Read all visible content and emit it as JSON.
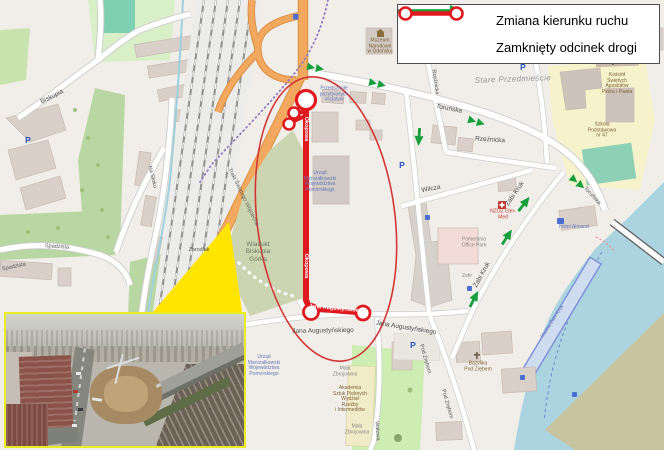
{
  "legend": {
    "items": [
      {
        "icon": "green-direction-arrow",
        "label": "Zmiana kierunku ruchu"
      },
      {
        "icon": "closed-road-segment",
        "label": "Zamknięty odcinek drogi"
      }
    ]
  },
  "colors": {
    "accent_red": "#e0191f",
    "arrow_green": "#179e3d",
    "highlight_yellow": "#ffe500",
    "water": "#abd4e0",
    "building": "#d9d0c9",
    "road_orange": "#f2a95f",
    "park": "#c9e3ae",
    "hill": "#cbd5b1",
    "khaki": "#c9c4a0",
    "bg": "#f1eee9"
  },
  "map": {
    "closed_section_streets": [
      "Okopowa",
      "Jana Augustyńskiego"
    ],
    "labels": [
      {
        "name": "street-torunska",
        "cls": "street",
        "text": "Toruńska",
        "x": 449,
        "y": 109,
        "rot": 11
      },
      {
        "name": "street-torunska-2",
        "cls": "street-sm",
        "text": "Toruńska",
        "x": 592,
        "y": 196,
        "rot": 48
      },
      {
        "name": "street-rzeznicka-v",
        "cls": "street-sm",
        "text": "Rzeźnicka",
        "x": 435,
        "y": 82,
        "rot": 82
      },
      {
        "name": "street-rzeznicka-h",
        "cls": "street",
        "text": "Rzeźnicka",
        "x": 490,
        "y": 140,
        "rot": 4
      },
      {
        "name": "area-stare-przedmiescie",
        "cls": "area",
        "text": "Stare Przedmieście",
        "x": 513,
        "y": 80,
        "rot": -2
      },
      {
        "name": "street-wilcza",
        "cls": "street",
        "text": "Wilcza",
        "x": 431,
        "y": 189,
        "rot": -11
      },
      {
        "name": "street-zabi-kruk-1",
        "cls": "street",
        "text": "Żabi Kruk",
        "x": 515,
        "y": 194,
        "rot": -55
      },
      {
        "name": "street-zabi-kruk-2",
        "cls": "street",
        "text": "Żabi Kruk",
        "x": 482,
        "y": 275,
        "rot": -62
      },
      {
        "name": "street-jana-aug-1",
        "cls": "street",
        "text": "Jana Augustyńskiego",
        "x": 323,
        "y": 331,
        "rot": -1
      },
      {
        "name": "street-jana-aug-2",
        "cls": "street",
        "text": "Jana Augustyńskiego",
        "x": 406,
        "y": 328,
        "rot": 9
      },
      {
        "name": "street-jana-aug-red",
        "cls": "onred",
        "text": "Jana Augustyńskiego",
        "x": 337,
        "y": 309,
        "rot": 5
      },
      {
        "name": "street-pod-zrebem-1",
        "cls": "street-sm",
        "text": "Pod Zrębem",
        "x": 425,
        "y": 359,
        "rot": 74
      },
      {
        "name": "street-pod-zrebem-2",
        "cls": "street-sm",
        "text": "Pod Zrębem",
        "x": 447,
        "y": 404,
        "rot": 74
      },
      {
        "name": "street-walowa",
        "cls": "street-sm",
        "text": "Wałowa",
        "x": 377,
        "y": 431,
        "rot": 86
      },
      {
        "name": "street-okopowa-red-1",
        "cls": "onred",
        "text": "Okopowa",
        "x": 306,
        "y": 129,
        "rot": 90
      },
      {
        "name": "street-okopowa-red-2",
        "cls": "onred",
        "text": "Okopowa",
        "x": 306,
        "y": 266,
        "rot": 90
      },
      {
        "name": "street-trakt",
        "cls": "street-sm",
        "text": "Trakt Świętego Wojciecha",
        "x": 243,
        "y": 197,
        "rot": 64
      },
      {
        "name": "street-biskupia",
        "cls": "street",
        "text": "Biskupia",
        "x": 52,
        "y": 97,
        "rot": -27
      },
      {
        "name": "street-na-stoku",
        "cls": "street-sm",
        "text": "Na Stoku",
        "x": 152,
        "y": 177,
        "rot": 76
      },
      {
        "name": "street-spadzista-1",
        "cls": "street-sm",
        "text": "Spadzista",
        "x": 57,
        "y": 247,
        "rot": 4
      },
      {
        "name": "street-spadzista-2",
        "cls": "street-sm",
        "text": "Spadzista",
        "x": 14,
        "y": 267,
        "rot": -12
      },
      {
        "name": "street-zaroslak",
        "cls": "street-sm",
        "text": "Zaroślak",
        "x": 199,
        "y": 250,
        "rot": 0
      },
      {
        "name": "area-wiadukt-biskupia-gorka",
        "cls": "hill-label",
        "text": "Wiadukt\nBiskupia\nGórka",
        "x": 258,
        "y": 252,
        "rot": 0
      },
      {
        "name": "poi-przedszkole",
        "cls": "poi-blue",
        "text": "Przedszkole\npozytywnych\ninicjatyw",
        "x": 334,
        "y": 95,
        "rot": 0
      },
      {
        "name": "poi-urzad-marszalkowski-1",
        "cls": "poi-blue",
        "text": "Urząd\nMarszałkowski\nWojewództwa\nPomorskiego",
        "x": 320,
        "y": 182,
        "rot": 0
      },
      {
        "name": "poi-urzad-marszalkowski-2",
        "cls": "poi-blue",
        "text": "Urząd\nMarszałkowski\nWojewództwa\nPomorskiego",
        "x": 264,
        "y": 366,
        "rot": 0
      },
      {
        "name": "poi-muzeum-narodowe",
        "cls": "poi-brown",
        "text": "Muzeum\nNarodowe\nw Gdańsku",
        "x": 380,
        "y": 47,
        "rot": 0
      },
      {
        "name": "poi-kosciol",
        "cls": "poi-brown",
        "text": "Kościół\nŚwiętych\nApostołów\nPiotra i Pawła",
        "x": 617,
        "y": 84,
        "rot": 0
      },
      {
        "name": "poi-szkola",
        "cls": "poi-brown",
        "text": "Szkoła\nPodstawowa\nnr 47",
        "x": 602,
        "y": 131,
        "rot": 0
      },
      {
        "name": "poi-eter-med",
        "cls": "poi-red",
        "text": "NZOZ Eter-\nMed",
        "x": 503,
        "y": 215,
        "rot": 0
      },
      {
        "name": "poi-pomerania",
        "cls": "poi-gray",
        "text": "Pomerania\nOffice Park",
        "x": 474,
        "y": 243,
        "rot": 0
      },
      {
        "name": "poi-zefir",
        "cls": "poi-gray",
        "text": "Zefir",
        "x": 467,
        "y": 277,
        "rot": 0
      },
      {
        "name": "poi-hotel-almond",
        "cls": "poi-blue",
        "text": "Hotel Almond",
        "x": 574,
        "y": 228,
        "rot": 0
      },
      {
        "name": "poi-marina-zabi-kruk",
        "cls": "poi-blue",
        "text": "Marina Żabi Kruk",
        "x": 553,
        "y": 322,
        "rot": -57
      },
      {
        "name": "poi-bazylika",
        "cls": "poi-brown",
        "text": "Bazylika\nPod Zrębem",
        "x": 478,
        "y": 367,
        "rot": 0
      },
      {
        "name": "poi-asp",
        "cls": "poi-brown",
        "text": "Akademia\nSztuk Pięknych\nWydział\nRzeźby\ni Intermediów",
        "x": 350,
        "y": 400,
        "rot": 0
      },
      {
        "name": "poi-mala-zbrojownia-1",
        "cls": "poi-gray",
        "text": "Mała\nZbrojownia",
        "x": 345,
        "y": 372,
        "rot": 0
      },
      {
        "name": "poi-mala-zbrojownia-2",
        "cls": "poi-gray",
        "text": "Mała\nZbrojownia",
        "x": 357,
        "y": 430,
        "rot": 0
      },
      {
        "name": "parking-icon-1",
        "cls": "p-icon",
        "text": "P",
        "x": 28,
        "y": 141,
        "rot": 0
      },
      {
        "name": "parking-icon-2",
        "cls": "p-icon",
        "text": "P",
        "x": 402,
        "y": 166,
        "rot": 0
      },
      {
        "name": "parking-icon-3",
        "cls": "p-icon",
        "text": "P",
        "x": 523,
        "y": 68,
        "rot": 0
      },
      {
        "name": "parking-icon-4",
        "cls": "p-icon",
        "text": "P",
        "x": 413,
        "y": 346,
        "rot": 0
      }
    ],
    "direction_arrows": [
      {
        "x": 316,
        "y": 68,
        "rot": 10,
        "double": true
      },
      {
        "x": 378,
        "y": 84,
        "rot": 13,
        "double": true
      },
      {
        "x": 477,
        "y": 122,
        "rot": 17,
        "double": true
      },
      {
        "x": 578,
        "y": 183,
        "rot": 40,
        "double": true
      },
      {
        "x": 419,
        "y": 137,
        "rot": 94,
        "double": false
      },
      {
        "x": 524,
        "y": 204,
        "rot": -52,
        "double": false
      },
      {
        "x": 507,
        "y": 237,
        "rot": -57,
        "double": false
      },
      {
        "x": 474,
        "y": 299,
        "rot": -63,
        "double": false
      }
    ]
  }
}
